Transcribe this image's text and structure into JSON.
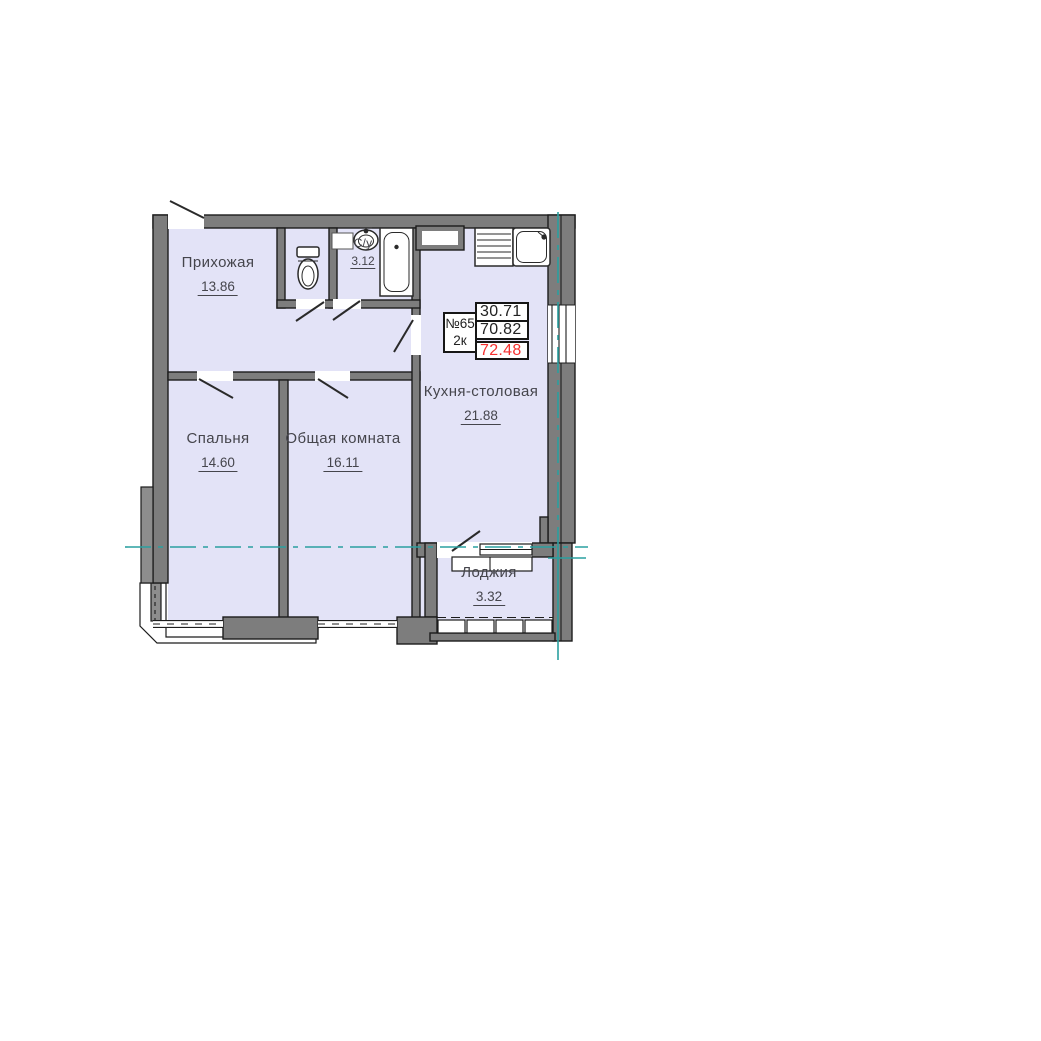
{
  "unit": {
    "number": "№65",
    "rooms_count": "2к",
    "living_area": "30.71",
    "area_excl_loggia": "70.82",
    "total_area": "72.48"
  },
  "rooms": {
    "hallway": {
      "name": "Прихожая",
      "area": "13.86"
    },
    "wc1": {
      "name": "С/у",
      "area": "1.25"
    },
    "wc2": {
      "name": "С/у",
      "area": "3.12"
    },
    "kitchen": {
      "name": "Кухня-столовая",
      "area": "21.88"
    },
    "bedroom": {
      "name": "Спальня",
      "area": "14.60"
    },
    "living": {
      "name": "Общая комната",
      "area": "16.11"
    },
    "loggia": {
      "name": "Лоджия",
      "area": "3.32"
    }
  },
  "colors": {
    "room_fill": "#e3e3f7",
    "wall": "#7d7d7d",
    "axis_teal": "#2aa0a0",
    "area_highlight": "#f53030",
    "line": "#1c1c1c",
    "text": "#45454c"
  }
}
